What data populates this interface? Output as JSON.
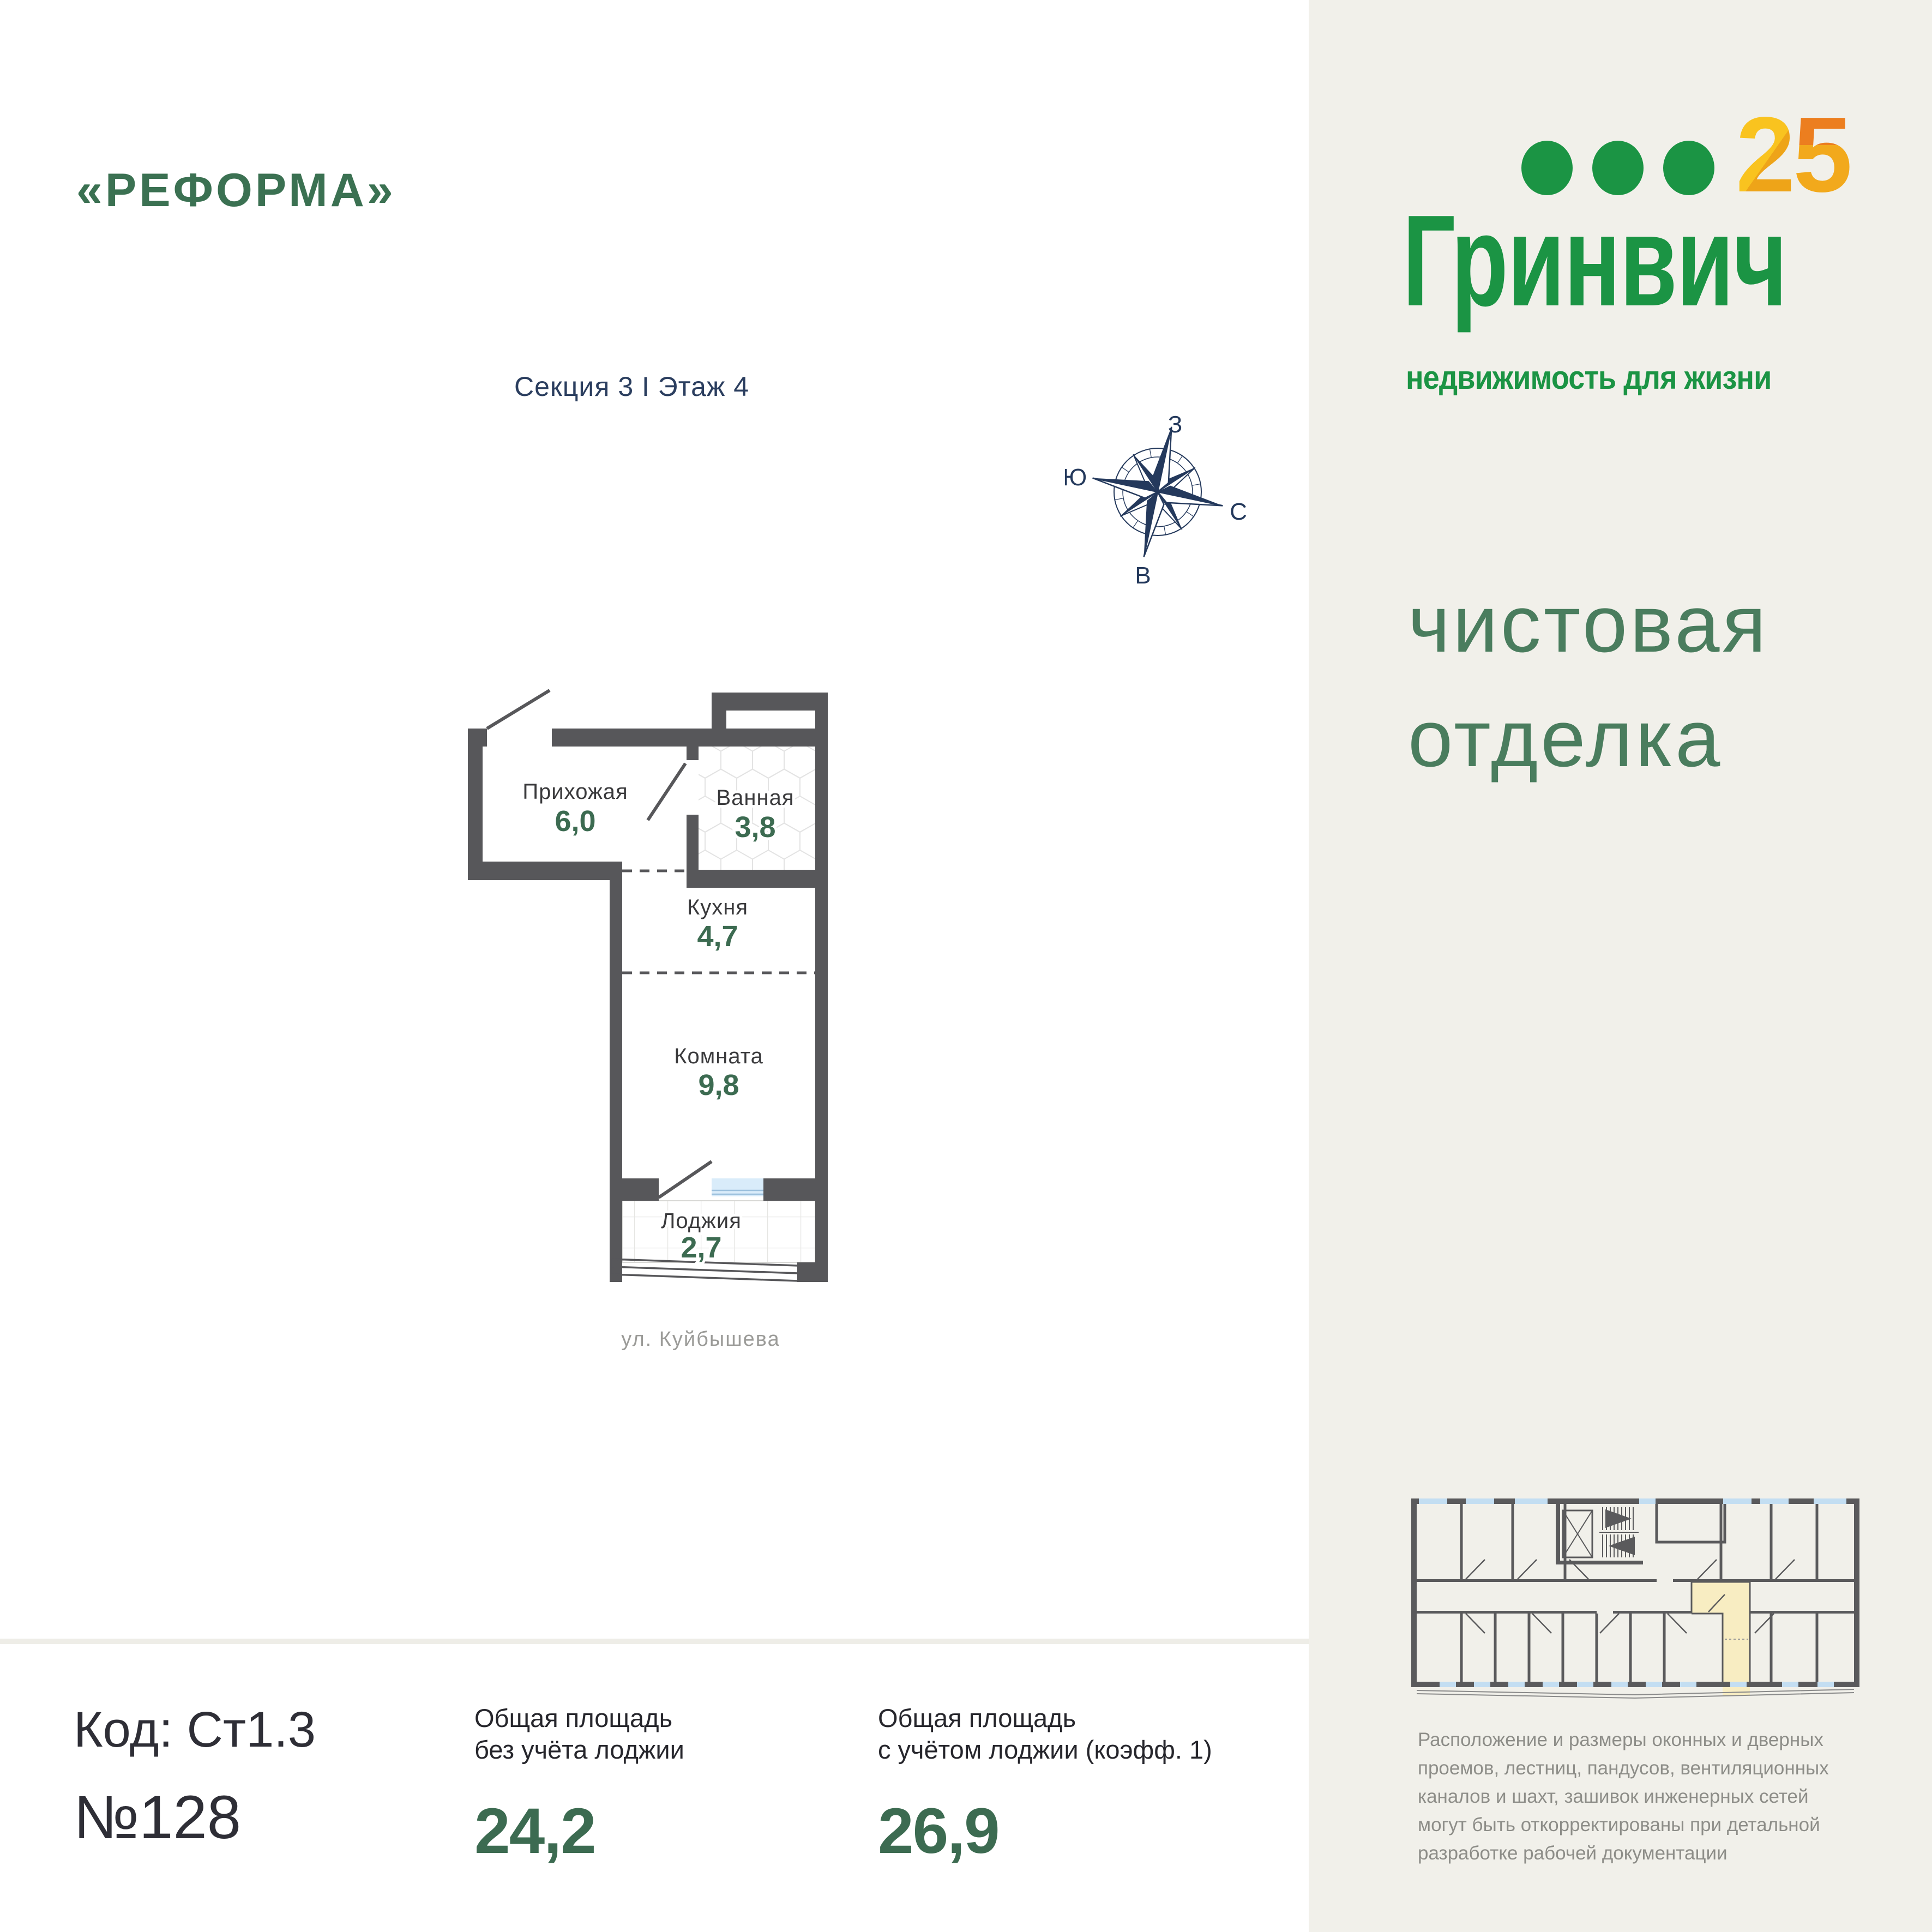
{
  "header": {
    "project_title": "«РЕФОРМА»",
    "section_floor": "Секция 3 I Этаж 4"
  },
  "logo": {
    "digit2": "2",
    "digit5": "5",
    "brand": "Гринвич",
    "tagline": "недвижимость для жизни"
  },
  "finish": {
    "line1": "чистовая",
    "line2": "отделка"
  },
  "compass": {
    "top": "З",
    "left": "Ю",
    "right": "С",
    "bottom": "В"
  },
  "plan": {
    "rooms": [
      {
        "name": "Прихожая",
        "area": "6,0"
      },
      {
        "name": "Ванная",
        "area": "3,8"
      },
      {
        "name": "Кухня",
        "area": "4,7"
      },
      {
        "name": "Комната",
        "area": "9,8"
      },
      {
        "name": "Лоджия",
        "area": "2,7"
      }
    ],
    "street": "ул. Куйбышева"
  },
  "summary": {
    "code": "Код: Ст1.3",
    "number": "№128",
    "area_without_loggia": {
      "label_line1": "Общая площадь",
      "label_line2": "без учёта лоджии",
      "value": "24,2"
    },
    "area_with_loggia": {
      "label_line1": "Общая площадь",
      "label_line2": "с учётом лоджии (коэфф. 1)",
      "value": "26,9"
    }
  },
  "disclaimer": {
    "lines": [
      "Расположение и размеры оконных и дверных",
      "проемов, лестниц, пандусов, вентиляционных",
      "каналов и шахт, зашивок инженерных сетей",
      "могут быть откорректированы при детальной",
      "разработке рабочей документации"
    ]
  },
  "colors": {
    "brand_green": "#1b9444",
    "heading_green": "#3b7152",
    "finish_green": "#4a7d5e",
    "area_green": "#3c6b51",
    "navy": "#2b3e5f",
    "wall_gray": "#57575a",
    "panel_beige": "#f1f0ea",
    "highlight_yellow": "#f8edc2",
    "window_blue": "#d9ecfa",
    "logo_yellow": "#f6b81c",
    "logo_orange": "#ee8a1f"
  }
}
